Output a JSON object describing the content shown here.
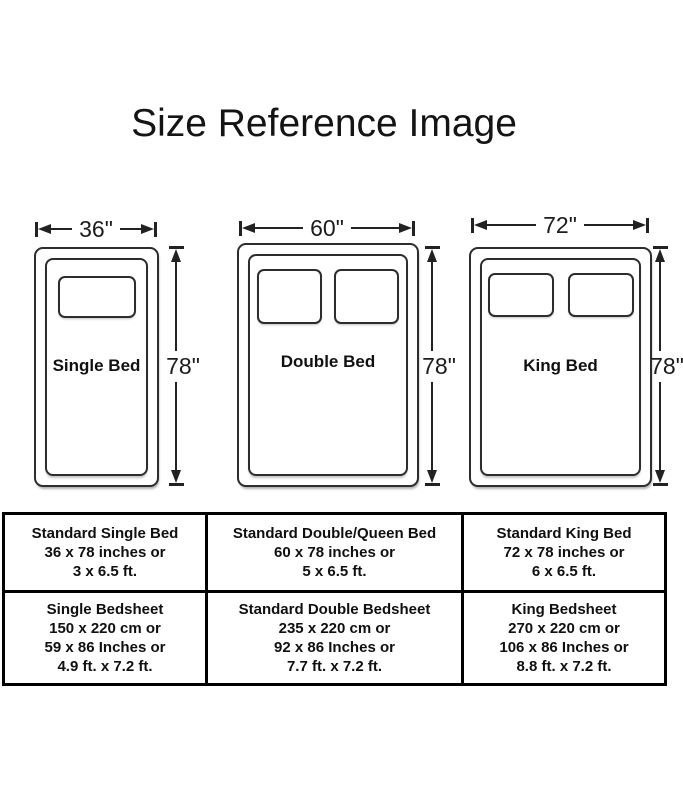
{
  "title": "Size Reference Image",
  "figures": [
    {
      "name": "Single Bed",
      "width_label": "36\"",
      "height_label": "78\"",
      "pillow_count": 1
    },
    {
      "name": "Double Bed",
      "width_label": "60\"",
      "height_label": "78\"",
      "pillow_count": 2
    },
    {
      "name": "King Bed",
      "width_label": "72\"",
      "height_label": "78\"",
      "pillow_count": 2
    }
  ],
  "table": {
    "rows": [
      {
        "cells": [
          {
            "lines": [
              "Standard Single Bed",
              "36 x 78 inches or",
              "3 x 6.5 ft."
            ]
          },
          {
            "lines": [
              "Standard Double/Queen Bed",
              "60 x 78 inches or",
              "5 x 6.5 ft."
            ]
          },
          {
            "lines": [
              "Standard King Bed",
              "72 x 78 inches or",
              "6 x 6.5 ft."
            ]
          }
        ]
      },
      {
        "cells": [
          {
            "lines": [
              "Single Bedsheet",
              "150 x 220 cm or",
              "59 x 86 Inches or",
              "4.9 ft. x 7.2 ft."
            ]
          },
          {
            "lines": [
              "Standard Double Bedsheet",
              "235 x 220 cm or",
              "92 x 86 Inches or",
              "7.7 ft. x 7.2 ft."
            ]
          },
          {
            "lines": [
              "King Bedsheet",
              "270 x 220 cm or",
              "106 x 86 Inches or",
              "8.8 ft. x 7.2 ft."
            ]
          }
        ]
      }
    ]
  }
}
